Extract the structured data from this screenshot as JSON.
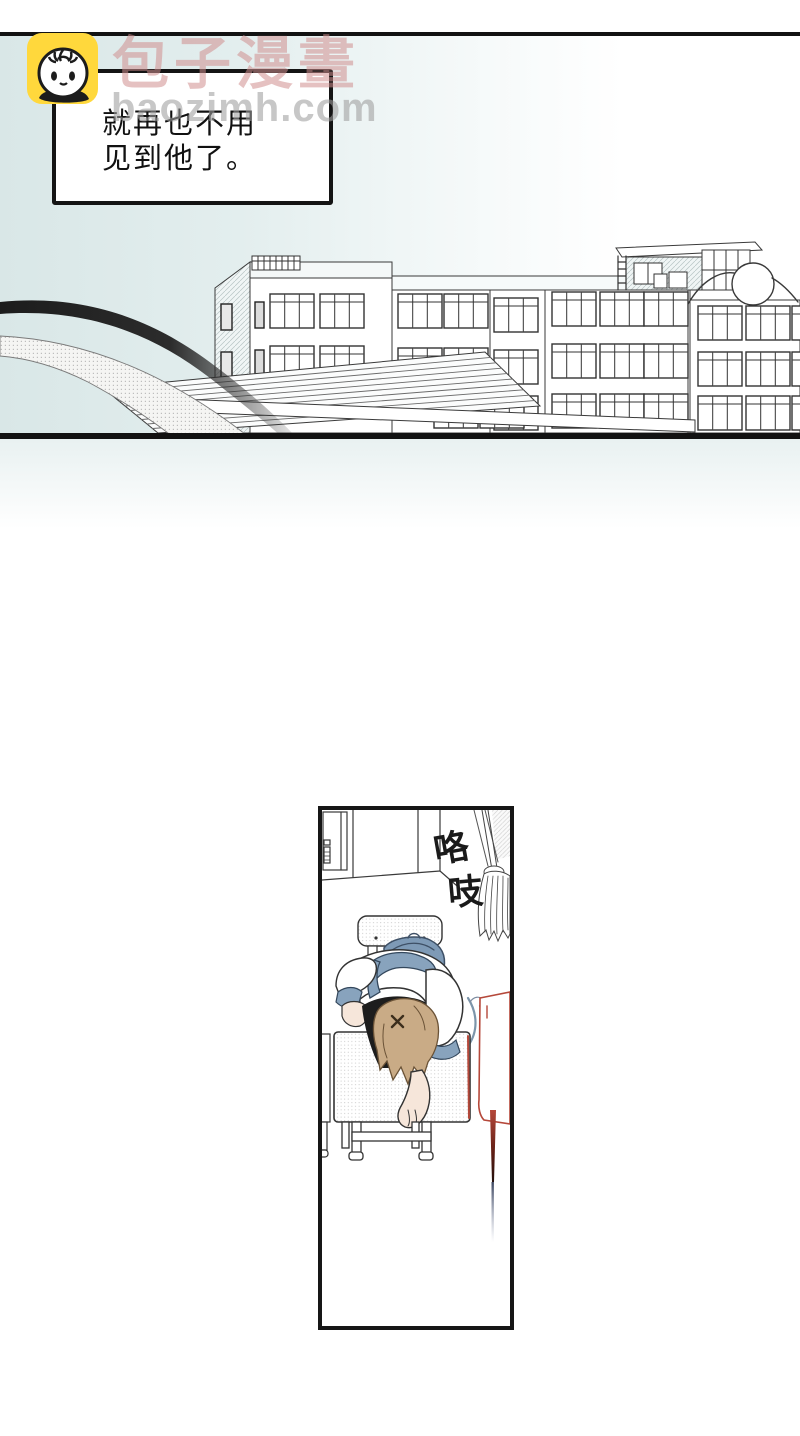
{
  "watermark": {
    "site_name": "包子漫畫",
    "site_domain": "baozimh.com"
  },
  "logo": {
    "icon": "baozi-bun-icon",
    "background_color": "#ffd83c"
  },
  "narration_box": {
    "line1": "就再也不用",
    "line2": "见到他了。"
  },
  "panel": {
    "sfx_char1": "咯",
    "sfx_char2": "吱"
  },
  "colors": {
    "rule_black": "#121212",
    "sky_left": "#d9e7e7",
    "line_art": "#3a3a3a",
    "uniform_blue": "#88a3bd",
    "bag_blue": "#7e9ab6",
    "hair_tan": "#c9ab86",
    "skin": "#f6e6da",
    "red_desk": "#b5483a",
    "logo_yellow": "#ffd83c"
  }
}
